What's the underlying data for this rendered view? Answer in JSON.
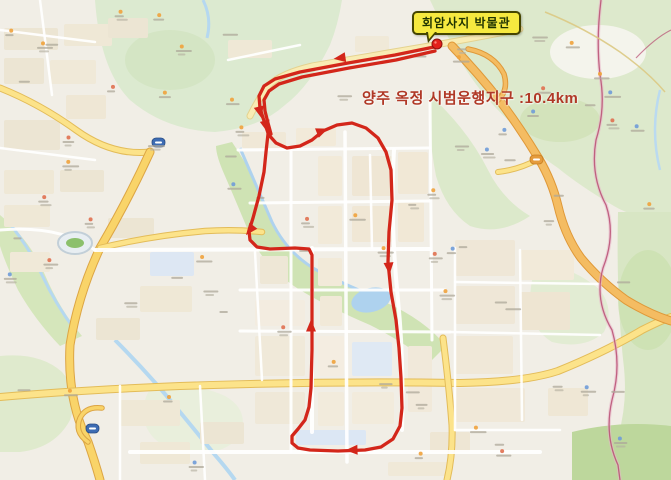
{
  "callout": {
    "text": "회암사지 박물관"
  },
  "banner": {
    "text": "양주 옥정 시범운행지구 :10.4km"
  },
  "colors": {
    "route": "#d3261a",
    "marker": "#e3201a",
    "marker_ring": "#8f120e",
    "callout_bg": "#f6e93f",
    "callout_border": "#454500",
    "callout_text": "#1f3300",
    "banner_text": "#b03826"
  },
  "route": {
    "marker": {
      "x": 437,
      "y": 44,
      "name": "museum-location"
    },
    "segments": [
      [
        [
          434,
          47
        ],
        [
          395,
          55
        ],
        [
          348,
          63
        ],
        [
          300,
          72
        ],
        [
          275,
          79
        ],
        [
          264,
          86
        ],
        [
          259,
          96
        ],
        [
          260,
          108
        ],
        [
          264,
          121
        ],
        [
          268,
          133
        ]
      ],
      [
        [
          435,
          51
        ],
        [
          396,
          60
        ],
        [
          349,
          68
        ],
        [
          302,
          77
        ],
        [
          279,
          84
        ],
        [
          269,
          91
        ],
        [
          264,
          100
        ],
        [
          265,
          111
        ],
        [
          268,
          123
        ],
        [
          271,
          134
        ]
      ],
      [
        [
          268,
          134
        ],
        [
          276,
          143
        ],
        [
          287,
          148
        ],
        [
          300,
          146
        ],
        [
          312,
          140
        ],
        [
          323,
          131
        ],
        [
          337,
          125
        ],
        [
          352,
          123
        ],
        [
          366,
          128
        ],
        [
          378,
          138
        ],
        [
          386,
          152
        ],
        [
          391,
          170
        ],
        [
          392,
          200
        ],
        [
          389,
          232
        ],
        [
          388,
          262
        ],
        [
          391,
          292
        ],
        [
          396,
          320
        ],
        [
          399,
          348
        ],
        [
          401,
          378
        ],
        [
          402,
          408
        ],
        [
          400,
          426
        ],
        [
          393,
          439
        ],
        [
          381,
          447
        ],
        [
          365,
          450
        ],
        [
          338,
          451
        ],
        [
          310,
          450
        ],
        [
          298,
          448
        ],
        [
          292,
          443
        ],
        [
          292,
          436
        ],
        [
          298,
          429
        ],
        [
          305,
          420
        ],
        [
          309,
          407
        ],
        [
          311,
          388
        ],
        [
          312,
          350
        ],
        [
          312,
          300
        ],
        [
          312,
          255
        ],
        [
          309,
          249
        ],
        [
          295,
          248
        ],
        [
          270,
          249
        ],
        [
          257,
          247
        ],
        [
          250,
          240
        ],
        [
          249,
          231
        ],
        [
          253,
          218
        ],
        [
          259,
          196
        ],
        [
          264,
          172
        ],
        [
          266,
          152
        ],
        [
          268,
          134
        ]
      ]
    ],
    "arrows": [
      {
        "x": 340,
        "y": 58,
        "a": 172
      },
      {
        "x": 260,
        "y": 112,
        "a": 76
      },
      {
        "x": 266,
        "y": 126,
        "a": 76
      },
      {
        "x": 250,
        "y": 230,
        "a": 128
      },
      {
        "x": 322,
        "y": 131,
        "a": -22
      },
      {
        "x": 389,
        "y": 268,
        "a": 85
      },
      {
        "x": 352,
        "y": 450,
        "a": 178
      },
      {
        "x": 311,
        "y": 326,
        "a": -90
      }
    ]
  }
}
